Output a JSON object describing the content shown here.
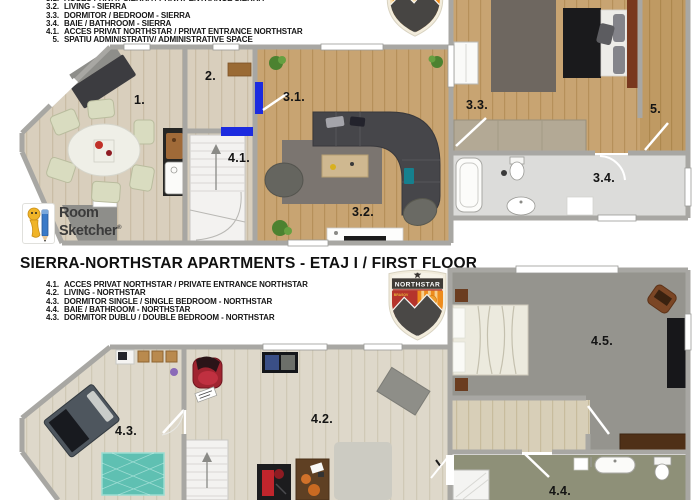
{
  "ground_floor": {
    "legend": {
      "clipped_line": {
        "num": "3.1.",
        "text": "ACCES PRIVAT SIERRA / PRIVAT ENTRANCE SIERRA"
      },
      "items": [
        {
          "num": "3.2.",
          "text": "LIVING - SIERRA"
        },
        {
          "num": "3.3.",
          "text": "DORMITOR / BEDROOM - SIERRA"
        },
        {
          "num": "3.4.",
          "text": "BAIE / BATHROOM - SIERRA"
        },
        {
          "num": "4.1.",
          "text": "ACCES PRIVAT NORTHSTAR / PRIVAT ENTRANCE NORTHSTAR"
        },
        {
          "num": "5.",
          "text": "SPATIU ADMINISTRATIV/ ADMINISTRATIVE SPACE"
        }
      ]
    },
    "room_labels": [
      {
        "id": "room-1",
        "text": "1."
      },
      {
        "id": "room-2",
        "text": "2."
      },
      {
        "id": "room-3-1",
        "text": "3.1."
      },
      {
        "id": "room-4-1",
        "text": "4.1."
      },
      {
        "id": "room-3-2",
        "text": "3.2."
      },
      {
        "id": "room-3-3",
        "text": "3.3."
      },
      {
        "id": "room-5",
        "text": "5."
      },
      {
        "id": "room-3-4",
        "text": "3.4."
      }
    ]
  },
  "first_floor": {
    "title": "SIERRA-NORTHSTAR APARTMENTS - ETAJ I / FIRST FLOOR",
    "legend": {
      "items": [
        {
          "num": "4.1.",
          "text": "ACCES PRIVAT NORTHSTAR / PRIVATE ENTRANCE NORTHSTAR"
        },
        {
          "num": "4.2.",
          "text": "LIVING - NORTHSTAR"
        },
        {
          "num": "4.3.",
          "text": "DORMITOR SINGLE / SINGLE BEDROOM - NORTHSTAR"
        },
        {
          "num": "4.4.",
          "text": "BAIE / BATHROOM - NORTHSTAR"
        },
        {
          "num": "4.3.",
          "text": "DORMITOR DUBLU / DOUBLE BEDROOM - NORTHSTAR"
        }
      ]
    },
    "room_labels": [
      {
        "id": "room-4-3",
        "text": "4.3."
      },
      {
        "id": "room-4-2",
        "text": "4.2."
      },
      {
        "id": "room-4-5",
        "text": "4.5."
      },
      {
        "id": "room-4-4",
        "text": "4.4."
      }
    ]
  },
  "branding": {
    "roomsketcher": {
      "line1": "Room",
      "line2": "Sketcher",
      "reg": "®"
    },
    "badge": {
      "name": "NORTHSTAR",
      "city": "BRASOV"
    }
  },
  "colors": {
    "door_accent_blue": "#1c2bdf",
    "badge_orange": "#ee8c1c",
    "badge_red": "#b5342c",
    "teal_rug": "#5fc0b2",
    "wall_gray": "#a8a7a3"
  }
}
